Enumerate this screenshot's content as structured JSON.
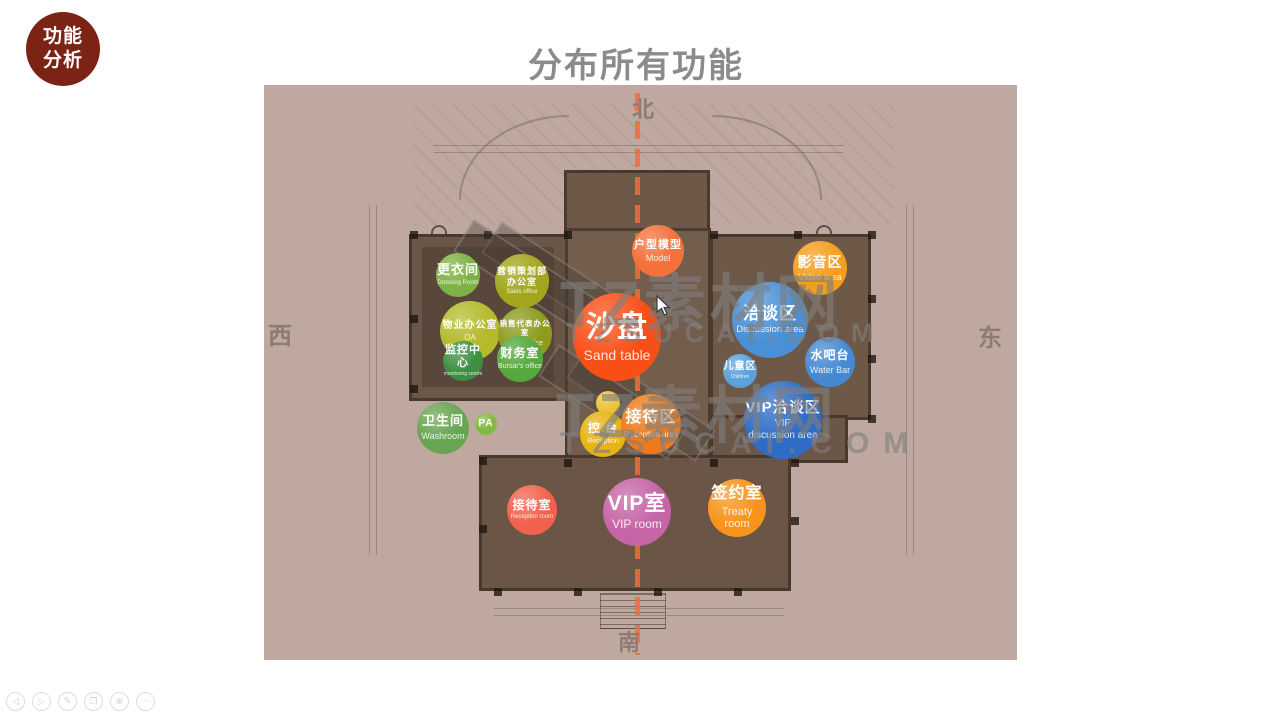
{
  "badge": {
    "line1": "功能",
    "line2": "分析",
    "color": "#7b2416"
  },
  "title": {
    "text": "分布所有功能",
    "color": "#8b8b8b"
  },
  "slide": {
    "bg_color": "#bfa8a0",
    "axis_color": "#ee6e3a"
  },
  "compass": {
    "north": "北",
    "south": "南",
    "east": "东",
    "west": "西"
  },
  "watermark": {
    "brand": "TZ素材网",
    "domain": "TZSUCAI.COM"
  },
  "zones": [
    {
      "id": "dressing-room",
      "label": "更衣间",
      "sub": "Dressing Room",
      "color": "#7db344",
      "cx": 194,
      "cy": 190,
      "d": 44,
      "fs": 13,
      "sfs": 6
    },
    {
      "id": "marketing-office",
      "label": "营销策划部",
      "label2": "办公室",
      "sub": "Sales office",
      "color": "#a2a51d",
      "cx": 258,
      "cy": 196,
      "d": 54,
      "fs": 9,
      "sfs": 6
    },
    {
      "id": "property-office",
      "label": "物业办公室",
      "sub": "OA",
      "color": "#b4ba2b",
      "cx": 206,
      "cy": 246,
      "d": 60,
      "fs": 10,
      "sfs": 8
    },
    {
      "id": "sales-rep-office",
      "label": "销售代表办公室",
      "sub": "Sales office",
      "color": "#8d9c1e",
      "cx": 261,
      "cy": 249,
      "d": 54,
      "fs": 7.5,
      "sfs": 7
    },
    {
      "id": "monitoring-center",
      "label": "监控中心",
      "sub": "monitoring centre",
      "color": "#3e8e41",
      "cx": 199,
      "cy": 276,
      "d": 40,
      "fs": 11,
      "sfs": 5
    },
    {
      "id": "finance-room",
      "label": "财务室",
      "sub": "Bursar's office",
      "color": "#55a83d",
      "cx": 256,
      "cy": 274,
      "d": 46,
      "fs": 12,
      "sfs": 7
    },
    {
      "id": "model-area",
      "label": "户型模型",
      "sub": "Model",
      "color": "#f4713b",
      "cx": 394,
      "cy": 166,
      "d": 52,
      "fs": 11,
      "sfs": 9
    },
    {
      "id": "sand-table",
      "label": "沙盘",
      "sub": "Sand table",
      "color": "#fa4e17",
      "cx": 353,
      "cy": 252,
      "d": 88,
      "fs": 30,
      "sfs": 14
    },
    {
      "id": "video-area",
      "label": "影音区",
      "sub": "Video area",
      "color": "#f59e1d",
      "cx": 556,
      "cy": 183,
      "d": 54,
      "fs": 14,
      "sfs": 9
    },
    {
      "id": "discussion-area",
      "label": "洽谈区",
      "sub": "Discussion area",
      "color": "#4a90d5",
      "cx": 506,
      "cy": 235,
      "d": 76,
      "fs": 17,
      "sfs": 9.5
    },
    {
      "id": "water-bar",
      "label": "水吧台",
      "sub": "Water Bar",
      "color": "#4489d2",
      "cx": 566,
      "cy": 277,
      "d": 50,
      "fs": 12,
      "sfs": 9
    },
    {
      "id": "children-area",
      "label": "儿童区",
      "sub": "Children",
      "color": "#5ba2dc",
      "cx": 476,
      "cy": 286,
      "d": 34,
      "fs": 10,
      "sfs": 5
    },
    {
      "id": "vip-discussion-area",
      "label": "VIP洽谈区",
      "sub": "VIP\ndiscussion area",
      "color": "#2e6cc6",
      "cx": 519,
      "cy": 335,
      "d": 78,
      "fs": 15,
      "sfs": 10
    },
    {
      "id": "washroom",
      "label": "卫生间",
      "sub": "Washroom",
      "color": "#68a551",
      "cx": 179,
      "cy": 343,
      "d": 52,
      "fs": 13,
      "sfs": 9
    },
    {
      "id": "pa-room",
      "label": "PA",
      "sub": "",
      "color": "#84ba43",
      "cx": 222,
      "cy": 339,
      "d": 22,
      "fs": 10,
      "sfs": 0
    },
    {
      "id": "service-dot",
      "label": "",
      "sub": "",
      "color": "#ecc43a",
      "cx": 344,
      "cy": 318,
      "d": 24,
      "fs": 0,
      "sfs": 0
    },
    {
      "id": "control-desk",
      "label": "控 台",
      "sub": "Reception",
      "color": "#e6b413",
      "cx": 339,
      "cy": 349,
      "d": 46,
      "fs": 12,
      "sfs": 7
    },
    {
      "id": "reception-area",
      "label": "接待区",
      "sub": "Reception area",
      "color": "#ee7b1b",
      "cx": 387,
      "cy": 339,
      "d": 60,
      "fs": 16,
      "sfs": 8
    },
    {
      "id": "reception-room",
      "label": "接待室",
      "sub": "Reception room",
      "color": "#f2614d",
      "cx": 268,
      "cy": 425,
      "d": 50,
      "fs": 12,
      "sfs": 6
    },
    {
      "id": "vip-room",
      "label": "VIP室",
      "sub": "VIP room",
      "color": "#c565a6",
      "cx": 373,
      "cy": 427,
      "d": 68,
      "fs": 21,
      "sfs": 12
    },
    {
      "id": "treaty-room",
      "label": "签约室",
      "sub": "Treaty room",
      "color": "#f8941c",
      "cx": 473,
      "cy": 423,
      "d": 58,
      "fs": 16,
      "sfs": 11
    }
  ],
  "toolbar": {
    "items": [
      {
        "name": "previous-slide",
        "glyph": "◁"
      },
      {
        "name": "next-slide",
        "glyph": "▷"
      },
      {
        "name": "pen-tool",
        "glyph": "✎"
      },
      {
        "name": "all-slides",
        "glyph": "❐"
      },
      {
        "name": "zoom-tool",
        "glyph": "⊕"
      },
      {
        "name": "more-options",
        "glyph": "⋯"
      }
    ]
  }
}
